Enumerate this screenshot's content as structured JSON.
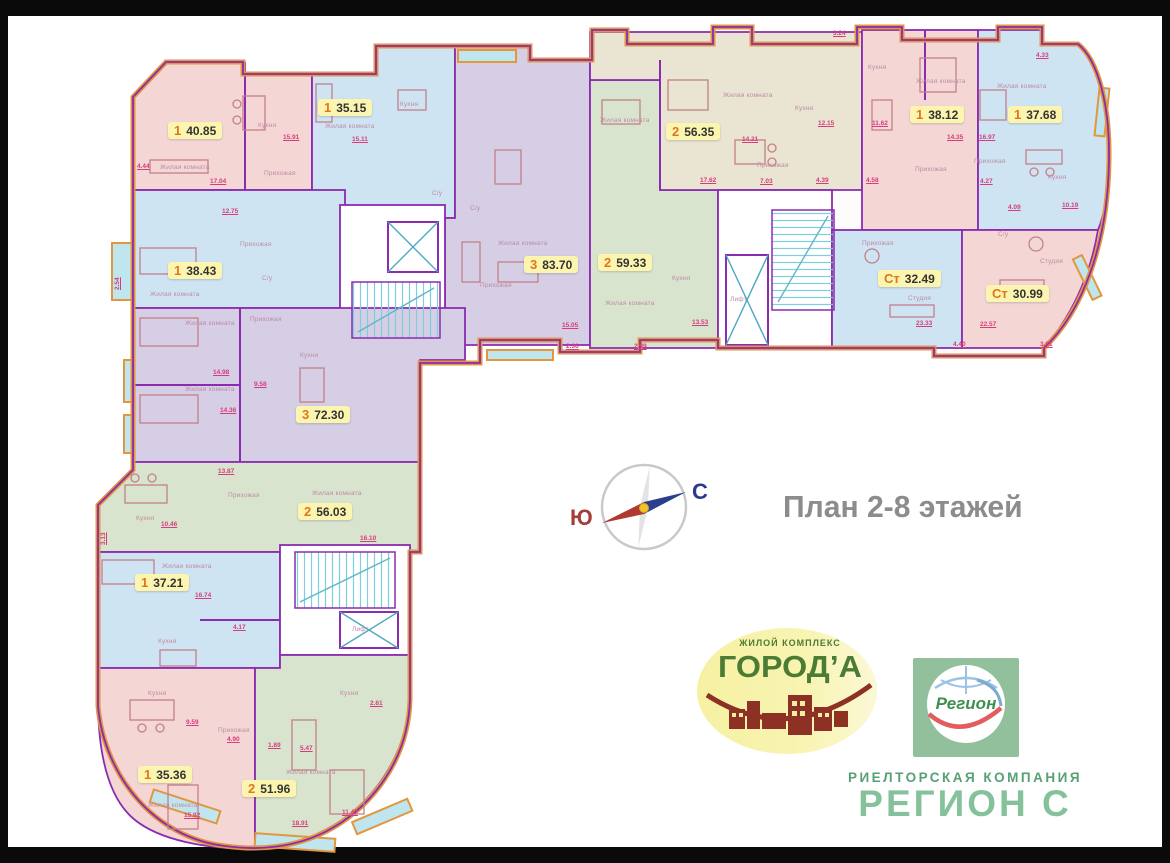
{
  "frame": {
    "background": "#0a0a0a",
    "canvas": "#ffffff"
  },
  "plan": {
    "title": "План 2-8 этажей",
    "compass": {
      "south": "Ю",
      "north": "С"
    },
    "apartments": [
      {
        "num": "1",
        "area": "40.85"
      },
      {
        "num": "1",
        "area": "35.15"
      },
      {
        "num": "3",
        "area": "83.70"
      },
      {
        "num": "2",
        "area": "56.35"
      },
      {
        "num": "2",
        "area": "59.33"
      },
      {
        "num": "1",
        "area": "38.12"
      },
      {
        "num": "1",
        "area": "37.68"
      },
      {
        "num": "Ст",
        "area": "32.49"
      },
      {
        "num": "Ст",
        "area": "30.99"
      },
      {
        "num": "1",
        "area": "38.43"
      },
      {
        "num": "3",
        "area": "72.30"
      },
      {
        "num": "2",
        "area": "56.03"
      },
      {
        "num": "1",
        "area": "37.21"
      },
      {
        "num": "1",
        "area": "35.36"
      },
      {
        "num": "2",
        "area": "51.96"
      }
    ],
    "room_labels": {
      "living": "Жилая комната",
      "kitchen": "Кухня",
      "hall": "Прихожая",
      "bath": "С/у",
      "studio": "Студия",
      "elevator": "Лифт"
    },
    "dims": [
      "4.44",
      "2.54",
      "17.04",
      "12.75",
      "15.91",
      "15.11",
      "3.24",
      "4.33",
      "12.15",
      "11.62",
      "14.35",
      "16.97",
      "4.27",
      "4.09",
      "10.19",
      "14.21",
      "17.62",
      "7.03",
      "4.39",
      "4.58",
      "23.33",
      "22.57",
      "4.40",
      "3.81",
      "15.05",
      "2.36",
      "2.99",
      "13.53",
      "14.98",
      "9.58",
      "14.36",
      "13.87",
      "10.46",
      "16.74",
      "4.17",
      "3.13",
      "9.59",
      "4.90",
      "15.92",
      "18.91",
      "11.47",
      "2.61",
      "5.47",
      "1.89",
      "16.10"
    ]
  },
  "logos": {
    "goroda": {
      "tagline": "ЖИЛОЙ КОМПЛЕКС",
      "name": "ГОРОД’А"
    },
    "region": {
      "mark": "Регион",
      "company_type": "РИЕЛТОРСКАЯ КОМПАНИЯ",
      "company_name": "РЕГИОН С"
    }
  },
  "palette": {
    "outer_wall": "#e2973f",
    "inner_wall": "#8a2bb0",
    "pink": "#f4d7d5",
    "blue": "#cfe4f2",
    "lavender": "#d5cee4",
    "green": "#d9e4cf",
    "beige": "#eae4d2",
    "glass": "#bfe6ef",
    "badge_bg": "#fcf5b0",
    "badge_num": "#e0761c",
    "dim_text": "#d63d7a"
  }
}
